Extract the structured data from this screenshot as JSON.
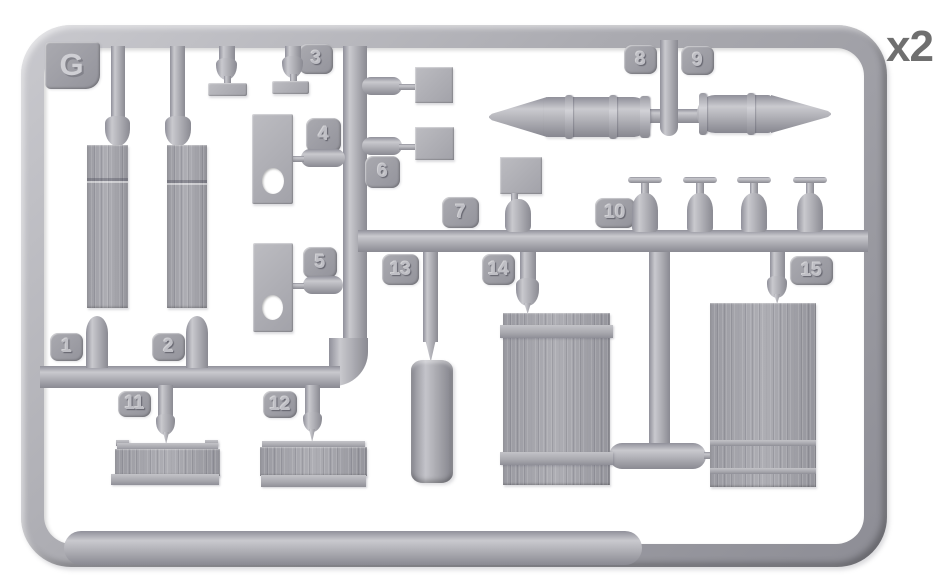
{
  "sprue": {
    "letter": "G",
    "quantity": "x2",
    "part_labels": [
      "1",
      "2",
      "3",
      "4",
      "5",
      "6",
      "7",
      "8",
      "9",
      "10",
      "11",
      "12",
      "13",
      "14",
      "15"
    ],
    "colors": {
      "background": "#ffffff",
      "plastic": "#a9a9af",
      "plastic_highlight": "#c9c9ce",
      "plastic_shadow": "#8a8a92",
      "label_plate": "#9b9ba1",
      "embossed_text": "#bfbfc5",
      "quantity_text": "#6f6f6f"
    },
    "parts": [
      {
        "number": "1",
        "shape": "long vertical wooden plank"
      },
      {
        "number": "2",
        "shape": "long vertical wooden plank"
      },
      {
        "number": "3",
        "shape": "two small flat strips"
      },
      {
        "number": "4",
        "shape": "rectangular plate with round hole"
      },
      {
        "number": "5",
        "shape": "rectangular plate with round hole"
      },
      {
        "number": "6",
        "shape": "two small square plates"
      },
      {
        "number": "7",
        "shape": "small square plate"
      },
      {
        "number": "8",
        "shape": "artillery shell pointing left"
      },
      {
        "number": "9",
        "shape": "artillery shell pointing right"
      },
      {
        "number": "10",
        "shape": "four small bottles with T-handles"
      },
      {
        "number": "11",
        "shape": "short horizontal wooden plank"
      },
      {
        "number": "12",
        "shape": "short horizontal wooden plank"
      },
      {
        "number": "13",
        "shape": "cylindrical drum"
      },
      {
        "number": "14",
        "shape": "wooden panel with battens"
      },
      {
        "number": "15",
        "shape": "large wooden panel"
      }
    ]
  }
}
